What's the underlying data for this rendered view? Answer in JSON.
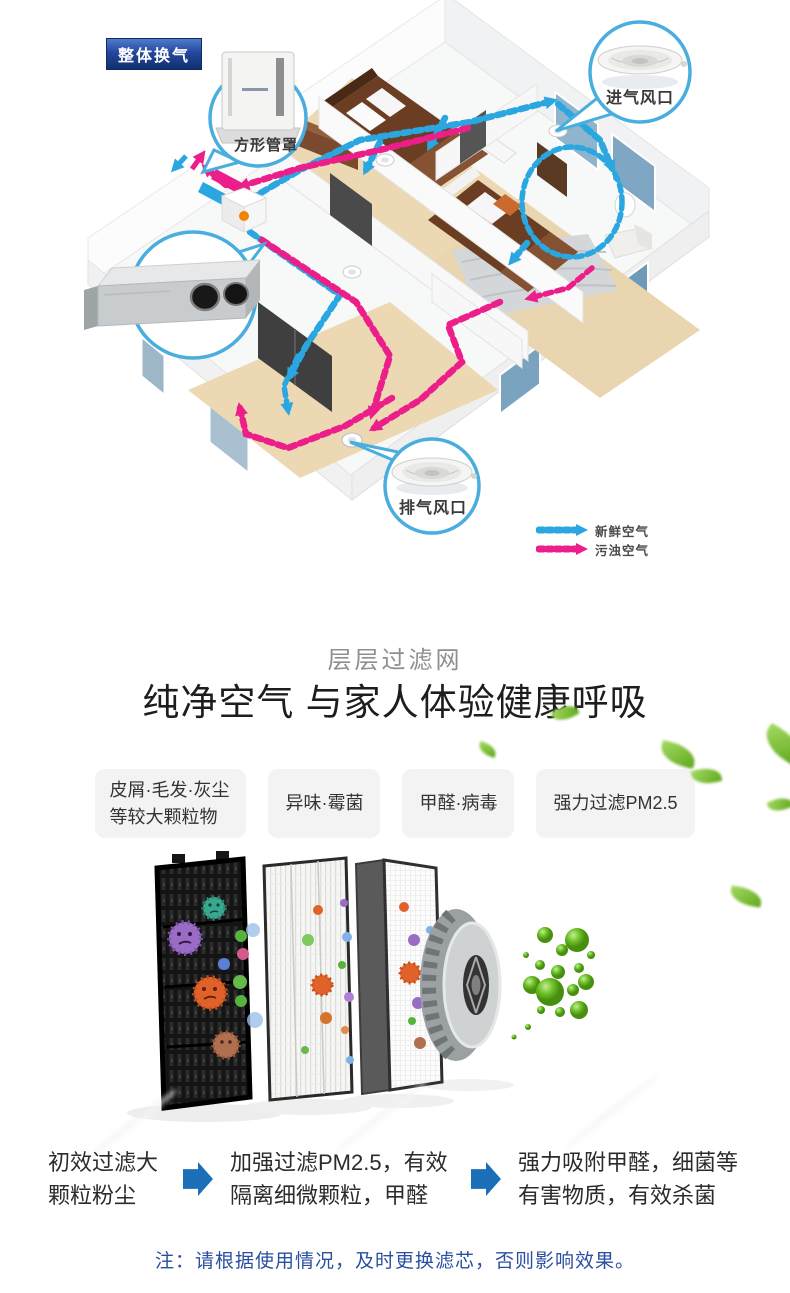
{
  "diagram": {
    "badge_label": "整体换气",
    "duct_cover_label": "方形管罩",
    "intake_vent_label": "进气风口",
    "exhaust_vent_label": "排气风口",
    "legend": {
      "fresh_air_label": "新鲜空气",
      "fresh_air_color": "#2aa7e0",
      "polluted_air_label": "污浊空气",
      "polluted_air_color": "#ec1f8a"
    }
  },
  "filter_section": {
    "subtitle": "层层过滤网",
    "title": "纯净空气 与家人体验健康呼吸",
    "tags": [
      {
        "label": "皮屑·毛发·灰尘\n等较大颗粒物"
      },
      {
        "label": "异味·霉菌"
      },
      {
        "label": "甲醛·病毒"
      },
      {
        "label": "强力过滤PM2.5"
      }
    ]
  },
  "process_steps": {
    "arrow_color": "#1b6fb8",
    "steps": [
      {
        "label": "初效过滤大\n颗粒粉尘"
      },
      {
        "label": "加强过滤PM2.5，有效\n隔离细微颗粒，甲醛"
      },
      {
        "label": "强力吸附甲醛，细菌等\n有害物质，有效杀菌"
      }
    ]
  },
  "note": "注：请根据使用情况，及时更换滤芯，否则影响效果。",
  "colors": {
    "badge_navy": "#12306f",
    "note_blue": "#2a4fa0",
    "leaf_green": "#6fbc2a",
    "wood_floor": "#ecd9b4"
  }
}
